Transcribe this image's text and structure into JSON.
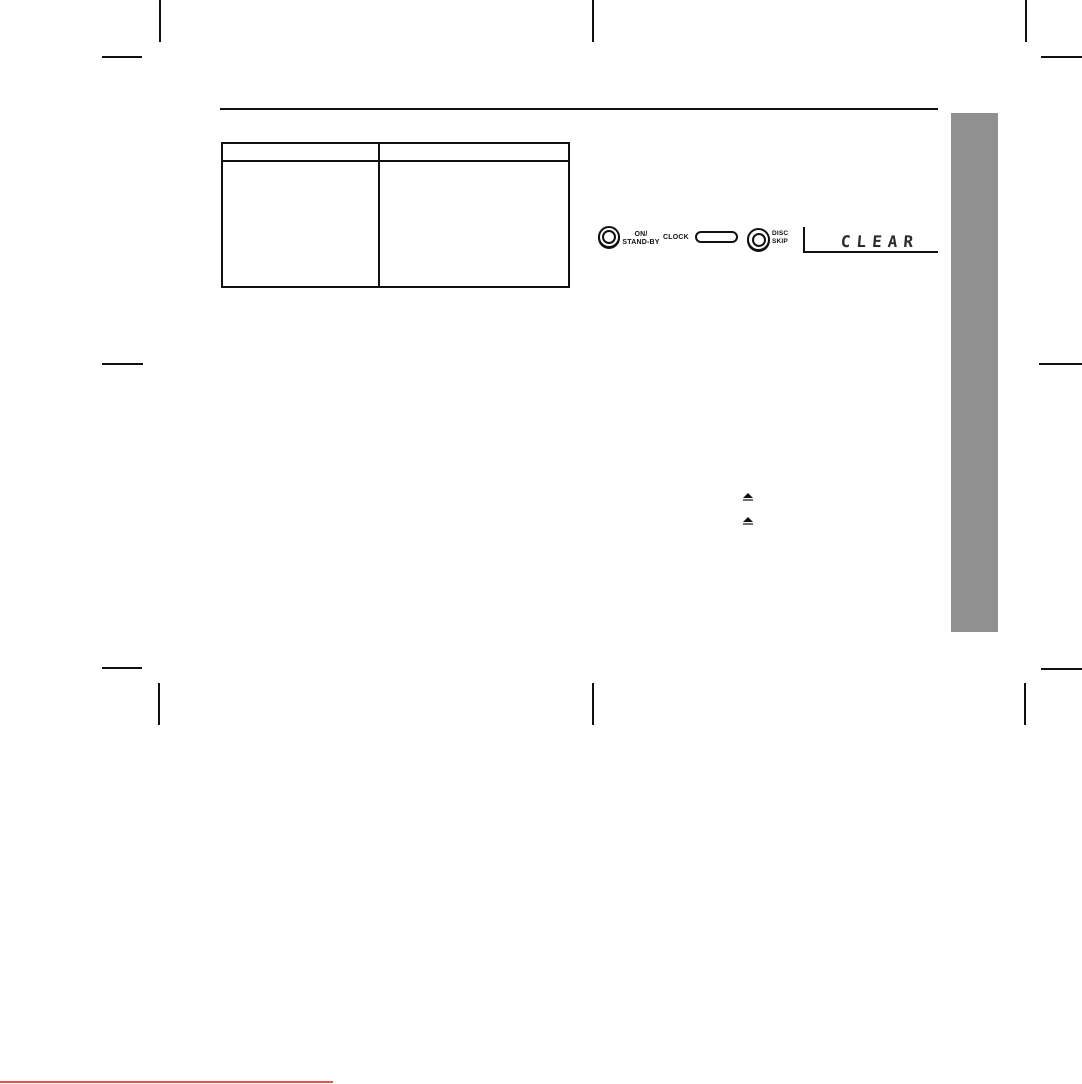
{
  "table": {
    "left_header": "",
    "right_header": "",
    "left_cell": "",
    "right_cell": ""
  },
  "panel": {
    "power_label_1": "ON/",
    "power_label_2": "STAND-BY",
    "clock_label": "CLOCK",
    "disc_label_1": "DISC",
    "disc_label_2": "SKIP",
    "display_text": "CLEAR"
  },
  "icons": {
    "eject_upper": "eject-icon",
    "eject_lower": "eject-icon"
  },
  "colors": {
    "sidebar_gray": "#909090",
    "accent_red": "#e8534e",
    "ink_black": "#111111"
  }
}
